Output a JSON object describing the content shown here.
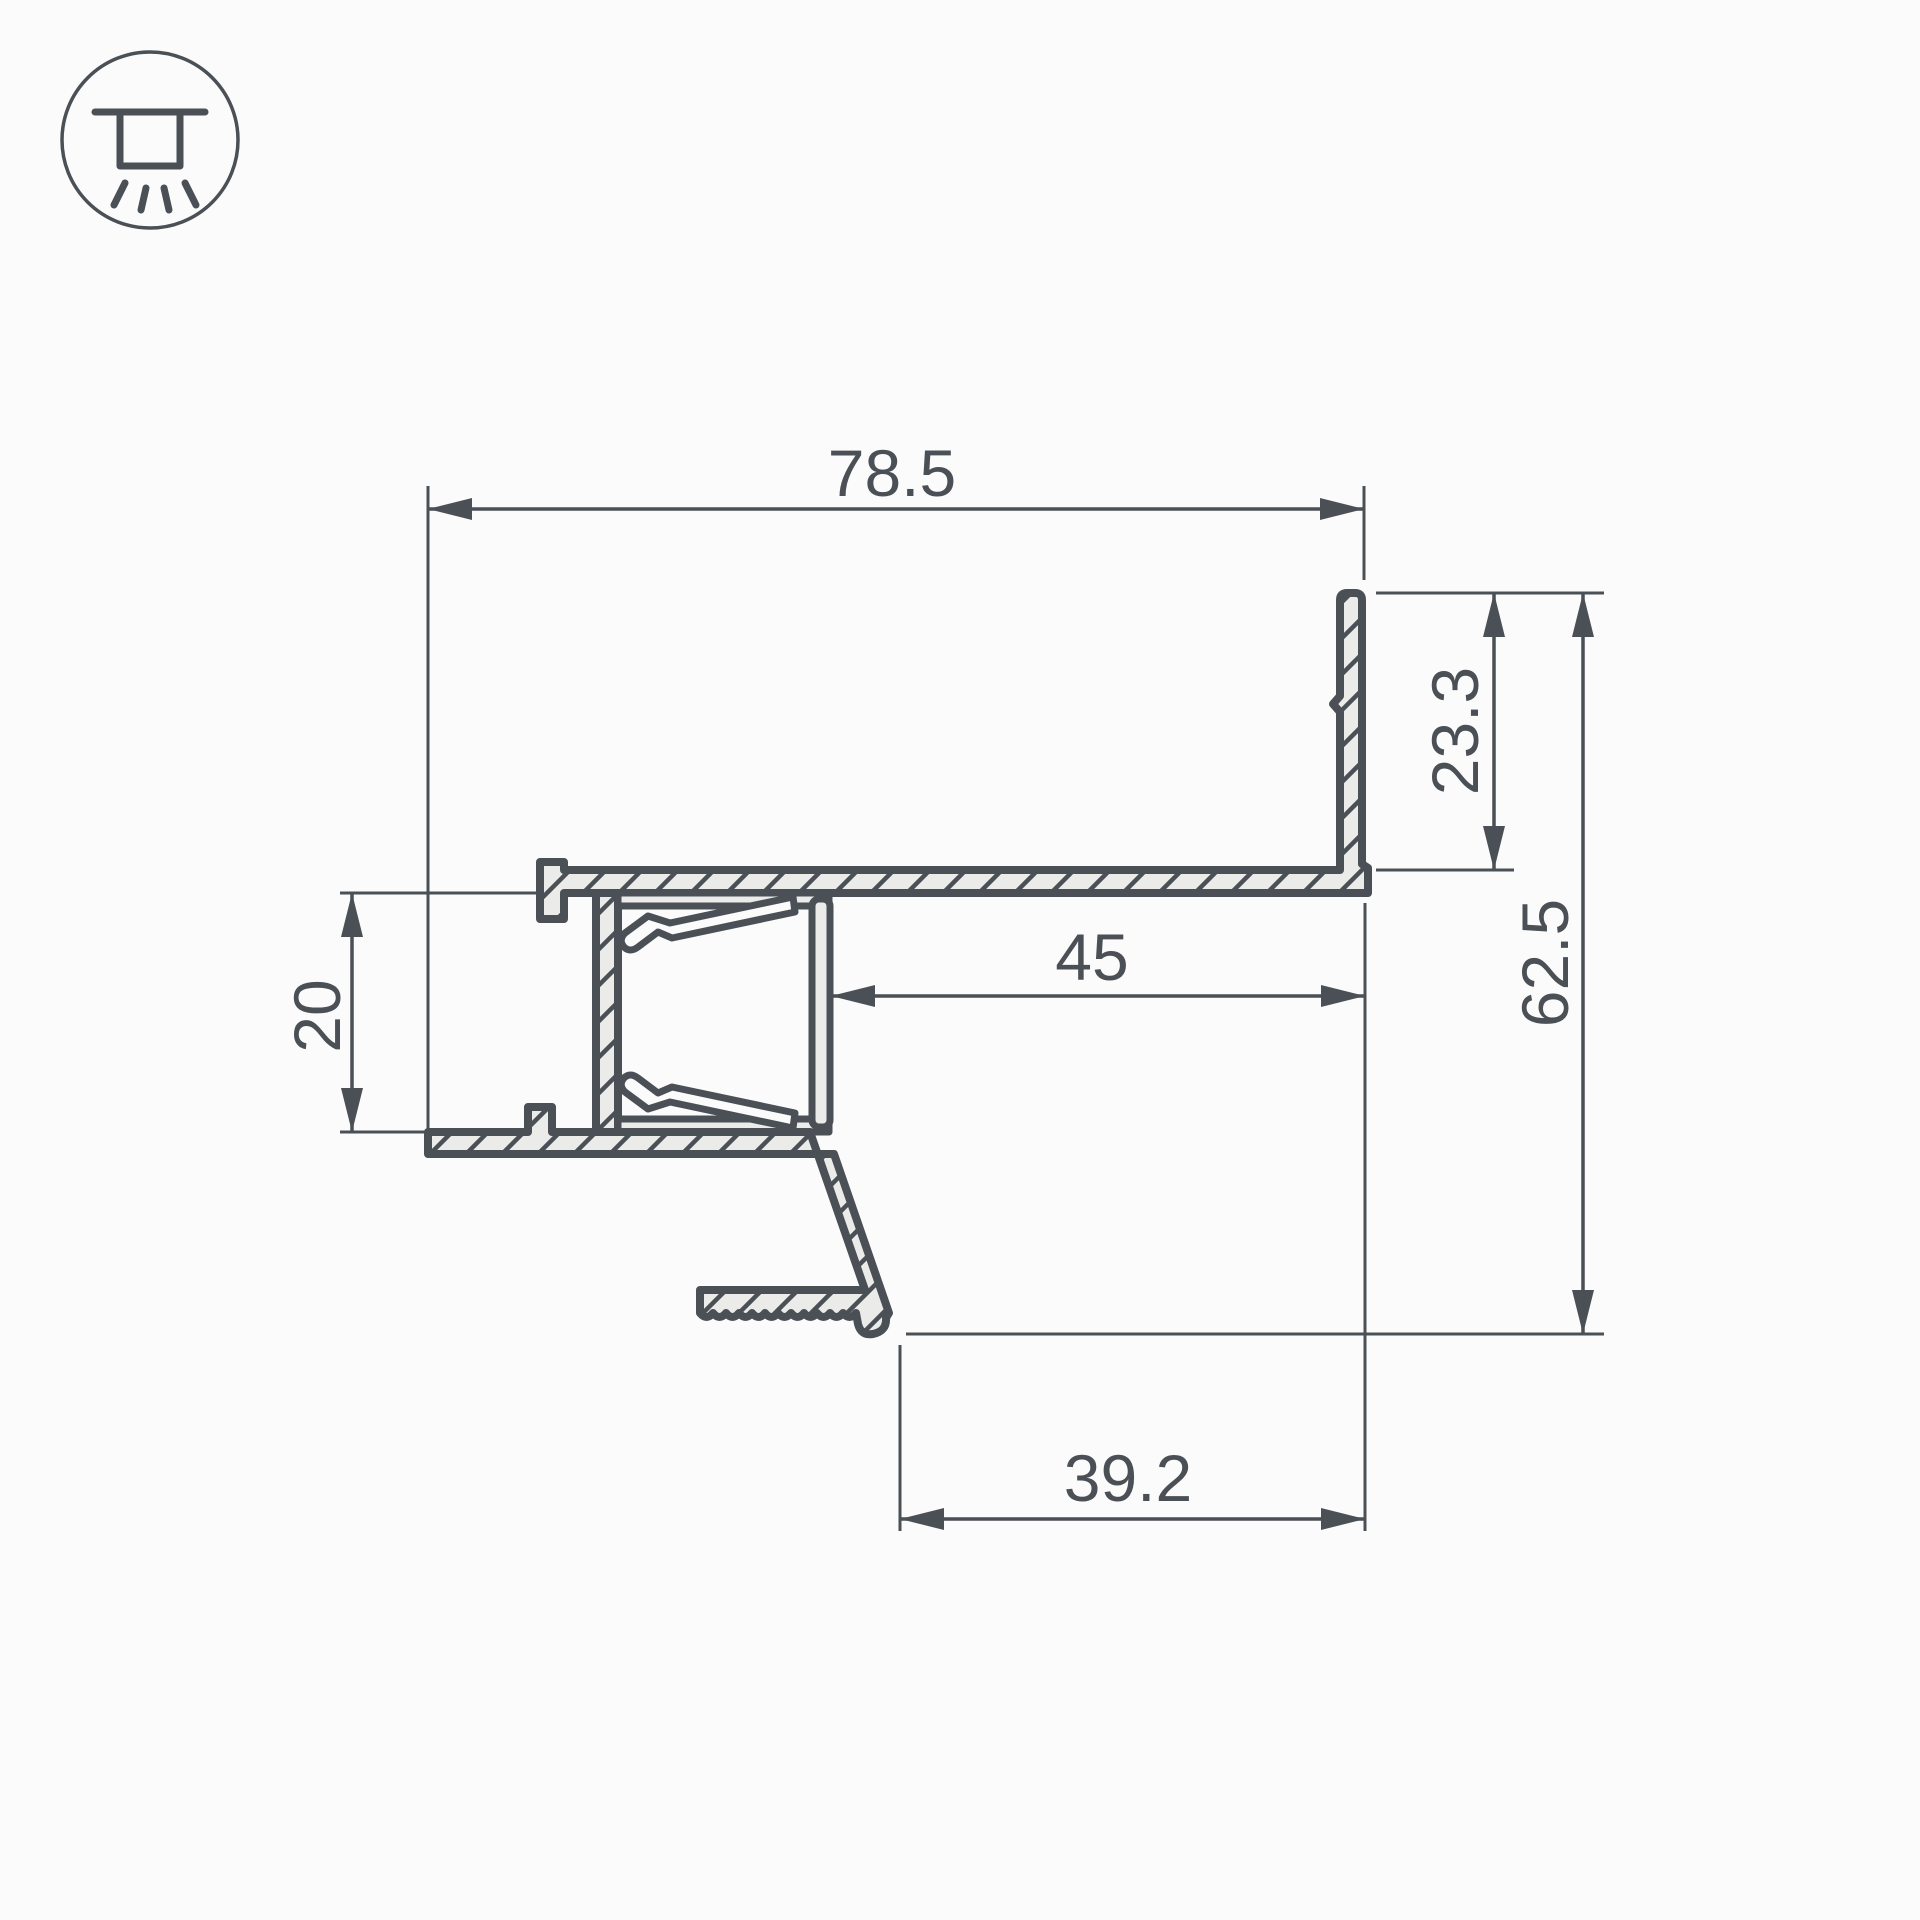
{
  "colors": {
    "background": "#fbfbfb",
    "line": "#4a5056",
    "profile_fill": "#ebebe9"
  },
  "icon": {
    "name": "recessed-ceiling-light"
  },
  "dims": {
    "overall_width": "78.5",
    "wall_height": "23.3",
    "overall_height": "62.5",
    "recess_width": "45",
    "plasterboard_gap": "20",
    "bottom_offset": "39.2"
  }
}
